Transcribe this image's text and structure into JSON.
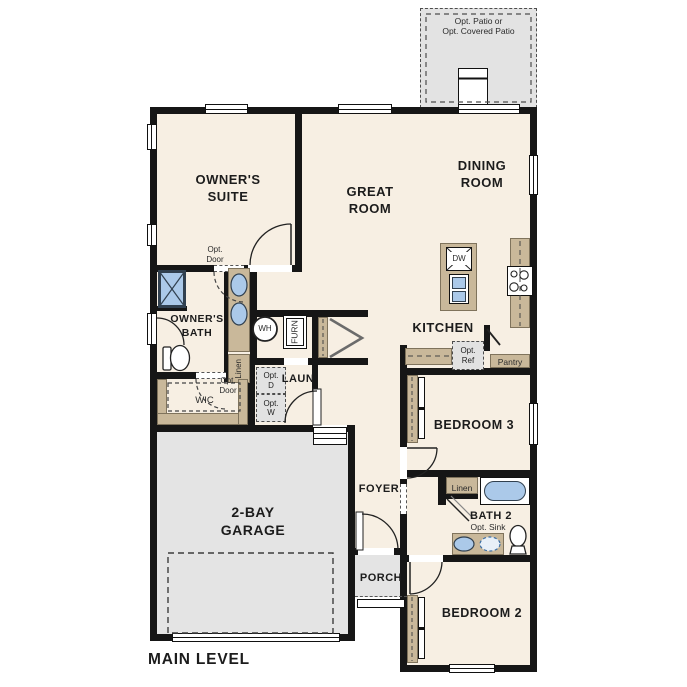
{
  "plan": {
    "title": "MAIN LEVEL",
    "rooms": {
      "patio": "Opt. Patio or\nOpt. Covered Patio",
      "owners_suite": "OWNER'S\nSUITE",
      "great_room": "GREAT\nROOM",
      "dining_room": "DINING\nROOM",
      "owners_bath": "OWNER'S\nBATH",
      "wic": "WIC",
      "laundry": "LAUN",
      "kitchen": "KITCHEN",
      "bedroom3": "BEDROOM 3",
      "bath2": "BATH 2",
      "foyer": "FOYER",
      "garage": "2-BAY\nGARAGE",
      "porch": "PORCH",
      "bedroom2": "BEDROOM 2"
    },
    "fixtures": {
      "opt_door_suite": "Opt.\nDoor",
      "opt_door_wic": "Opt.\nDoor",
      "linen_owner": "Linen",
      "linen_bath2": "Linen",
      "water_heater": "WH",
      "furnace": "FURN",
      "opt_dryer": "Opt.\nD",
      "opt_washer": "Opt.\nW",
      "dishwasher": "DW",
      "opt_refrigerator": "Opt.\nRef",
      "pantry": "Pantry",
      "opt_sink": "Opt. Sink"
    },
    "colors": {
      "floor": "#f7efe3",
      "wall": "#161616",
      "garage_gray": "#e4e4e4",
      "cabinet_tan": "#c9b89a",
      "fixture_blue": "#abc9e9",
      "opt_box_gray": "#e2e2e2"
    }
  }
}
